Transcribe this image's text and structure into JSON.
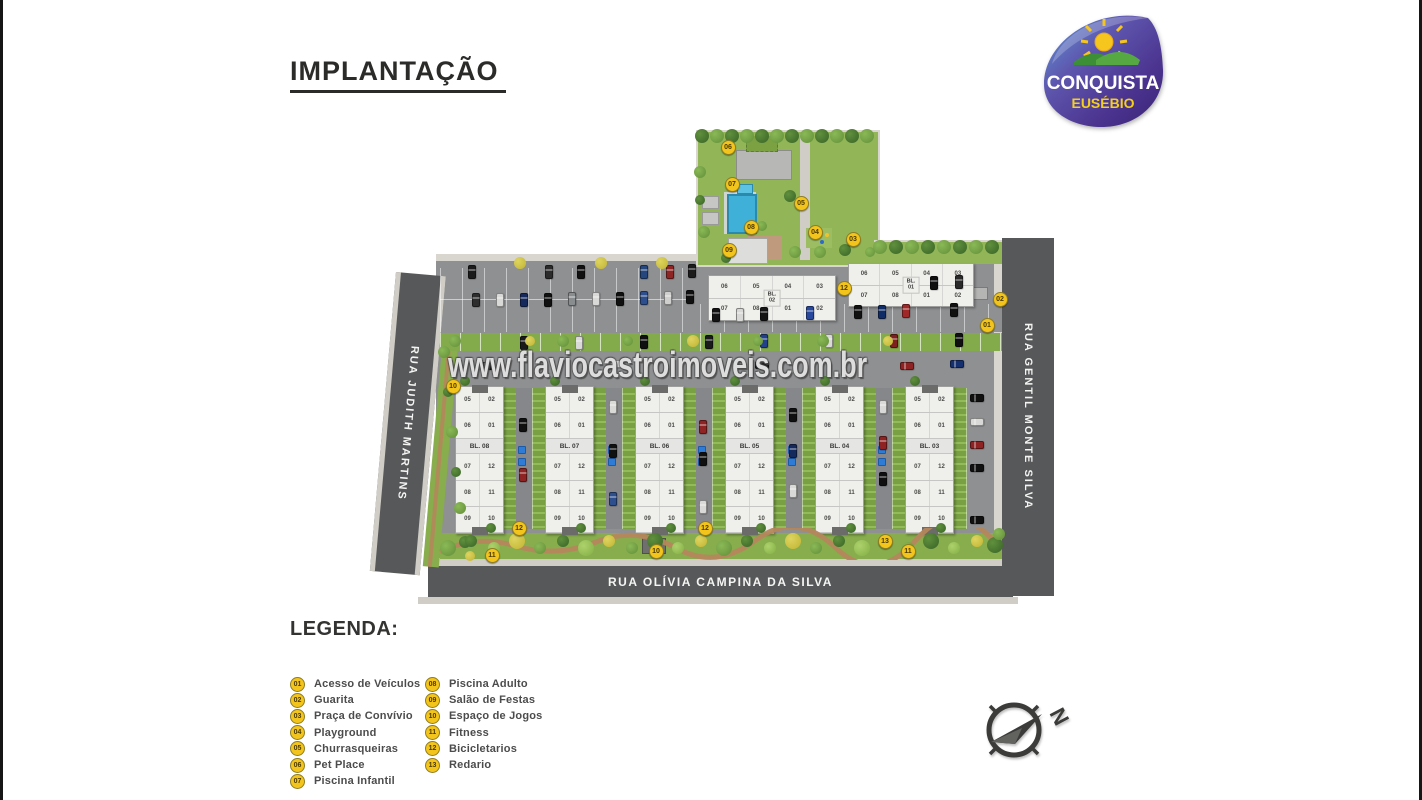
{
  "title": "IMPLANTAÇÃO",
  "watermark": "www.flaviocastroimoveis.com.br",
  "logo": {
    "name": "CONQUISTA",
    "city": "EUSÉBIO"
  },
  "streets": {
    "left": "RUA JUDITH MARTINS",
    "right": "RUA GENTIL MONTE SILVA",
    "bottom": "RUA OLÍVIA CAMPINA DA SILVA"
  },
  "compass": {
    "north": "N"
  },
  "legend": {
    "heading": "LEGENDA:",
    "column1": [
      {
        "num": "01",
        "label": "Acesso de Veículos"
      },
      {
        "num": "02",
        "label": "Guarita"
      },
      {
        "num": "03",
        "label": "Praça de Convívio"
      },
      {
        "num": "04",
        "label": "Playground"
      },
      {
        "num": "05",
        "label": "Churrasqueiras"
      },
      {
        "num": "06",
        "label": "Pet Place"
      },
      {
        "num": "07",
        "label": "Piscina Infantil"
      }
    ],
    "column2": [
      {
        "num": "08",
        "label": "Piscina Adulto"
      },
      {
        "num": "09",
        "label": "Salão de Festas"
      },
      {
        "num": "10",
        "label": "Espaço de Jogos"
      },
      {
        "num": "11",
        "label": "Fitness"
      },
      {
        "num": "12",
        "label": "Bicicletarios"
      },
      {
        "num": "13",
        "label": "Redario"
      }
    ]
  },
  "plan": {
    "horizontal_buildings": [
      {
        "block": "BL.",
        "number": "02",
        "top_units": [
          "06",
          "05",
          "04",
          "03"
        ],
        "bottom_units": [
          "07",
          "08",
          "01",
          "02"
        ]
      },
      {
        "block": "BL.",
        "number": "01",
        "top_units": [
          "06",
          "05",
          "04",
          "03"
        ],
        "bottom_units": [
          "07",
          "08",
          "01",
          "02"
        ]
      }
    ],
    "vertical_buildings": [
      {
        "label": "BL. 08"
      },
      {
        "label": "BL. 07"
      },
      {
        "label": "BL. 06"
      },
      {
        "label": "BL. 05"
      },
      {
        "label": "BL. 04"
      },
      {
        "label": "BL. 03"
      }
    ],
    "vertical_unit_rows": [
      [
        "05",
        "02"
      ],
      [
        "06",
        "01"
      ],
      [
        "07",
        "12"
      ],
      [
        "08",
        "11"
      ],
      [
        "09",
        "10"
      ]
    ],
    "markers": [
      {
        "num": "06",
        "x": 727,
        "y": 146
      },
      {
        "num": "07",
        "x": 731,
        "y": 183
      },
      {
        "num": "05",
        "x": 800,
        "y": 202
      },
      {
        "num": "08",
        "x": 750,
        "y": 226
      },
      {
        "num": "04",
        "x": 814,
        "y": 231
      },
      {
        "num": "03",
        "x": 852,
        "y": 238
      },
      {
        "num": "09",
        "x": 728,
        "y": 249
      },
      {
        "num": "12",
        "x": 843,
        "y": 287
      },
      {
        "num": "02",
        "x": 999,
        "y": 298
      },
      {
        "num": "01",
        "x": 986,
        "y": 324
      },
      {
        "num": "10",
        "x": 452,
        "y": 385
      },
      {
        "num": "12",
        "x": 518,
        "y": 527
      },
      {
        "num": "12",
        "x": 704,
        "y": 527
      },
      {
        "num": "10",
        "x": 655,
        "y": 550
      },
      {
        "num": "11",
        "x": 491,
        "y": 554
      },
      {
        "num": "13",
        "x": 884,
        "y": 540
      },
      {
        "num": "11",
        "x": 907,
        "y": 550
      }
    ]
  },
  "colors": {
    "road": "#57585a",
    "asphalt": "#8e9092",
    "grass": "#87ad4d",
    "pavers": "#79a043",
    "marker": "#f2c41c",
    "building": "#efefec",
    "pool": "#3fb0d8",
    "legend_text": "#4c4c4c"
  }
}
